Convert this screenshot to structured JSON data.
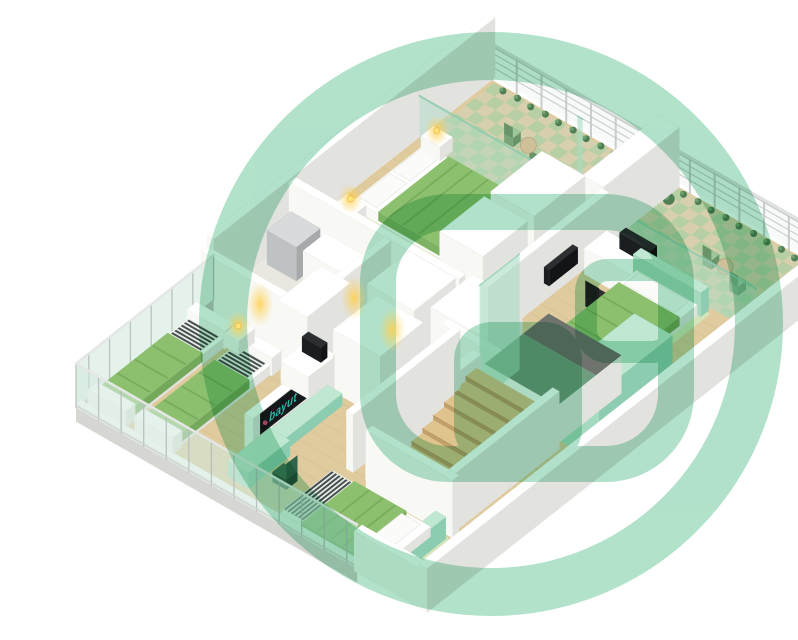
{
  "meta": {
    "alt": "3D isometric floor plan with bedrooms, balconies, bathroom and staircase"
  },
  "branding": {
    "tv_label": "bayut",
    "tv_label_color": "#2bb9ab",
    "tv_accent_color": "#e84b70",
    "watermark_color": "#abdfc6",
    "watermark_opacity": 0.92
  },
  "palette": {
    "floorWood": "#e0cb9e",
    "woodLine": "#d2bb8c",
    "floorBath": "#eae7e1",
    "tileBase": "#d8cfae",
    "tileGreen": "#9ccf9d",
    "matGreen": "#d4e7bc",
    "bedGreen": "#8cc06e",
    "bedGreenDark": "#74a85a",
    "bedDrape": "#7cb262",
    "stripeDark": "#3a4344",
    "stripeBase": "#eef0ea",
    "pillow": "#fbfbf9",
    "glassMint": "#a9dcc3",
    "glassPale": "#e3efe9",
    "slabGray": "#d6d6d2",
    "slabSide": "#c6c6c2",
    "railGlass": "#eff5f2",
    "railBar": "#c8cdcc",
    "railPost": "#c2c7c6",
    "railTop": "#dfe2e0",
    "mullion": "#b6bcba",
    "glassTopRail": "#e4e7e5",
    "stairWood": "#e0c48e",
    "stairRiser": "#c2a06a",
    "stairNose": "#b3925c",
    "landingGreen": "#6e9d7f",
    "voidGray": "#6e736e",
    "screenBlack": "#15181a",
    "tableTan": "#cfc09a",
    "plantDark": "#4f7f55",
    "plantLight": "#6fa06f",
    "mats": {
      "white": {
        "top": "#ffffff",
        "front": "#f8f8f5",
        "side": "#e2e2de"
      },
      "mint": {
        "top": "#c0e7d2",
        "front": "#a5dac1",
        "side": "#8cccb0"
      },
      "gray": {
        "top": "#d8dadb",
        "front": "#bfc2c3",
        "side": "#a6a9aa"
      },
      "dark": {
        "top": "#2b2f31",
        "front": "#1b1e20",
        "side": "#121415"
      },
      "chairBlack": {
        "top": "#2c3031",
        "front": "#1e2122",
        "side": "#151718"
      },
      "chairGreen": {
        "top": "#3c7b5a",
        "front": "#2f654a",
        "side": "#25543c"
      },
      "chairLeaf": {
        "top": "#9cc79d",
        "front": "#7aa57b",
        "side": "#699469"
      }
    }
  },
  "projection": {
    "origin": [
      452,
      64
    ],
    "u": [
      0.868,
      0.497
    ],
    "v": [
      -0.8,
      0.63
    ]
  },
  "watermark": {
    "ring": {
      "cx": 451,
      "cy": 308,
      "r": 268,
      "sw": 48
    },
    "outline": {
      "x": 338,
      "y": 196,
      "w": 298,
      "h": 252,
      "rx": 70,
      "sw": 36
    },
    "window": {
      "x": 546,
      "y": 254,
      "w": 88,
      "h": 82,
      "rx": 22,
      "sw": 22
    },
    "door": {
      "x": 414,
      "y": 306,
      "w": 128,
      "h": 144,
      "rx": 38
    }
  },
  "lights": {
    "lamps": [
      [
        23,
        94,
        20
      ],
      [
        23,
        202,
        20
      ],
      [
        56,
        378,
        20
      ]
    ],
    "glows": [
      [
        220,
        288
      ],
      [
        314,
        282
      ],
      [
        352,
        314
      ]
    ]
  },
  "scene": {
    "items": [
      {
        "t": "flat",
        "n": "floor-slab",
        "r": [
          0,
          0,
          398,
          520
        ],
        "f": "floorWood"
      },
      {
        "t": "woodlines",
        "n": "floor-planks",
        "r": [
          0,
          96,
          398,
          520
        ],
        "step": 14,
        "f": "woodLine"
      },
      {
        "t": "flat",
        "n": "bathroom-floor",
        "r": [
          0,
          250,
          116,
          360
        ],
        "f": "floorBath"
      },
      {
        "t": "flat",
        "n": "balcony-floor",
        "r": [
          4,
          2,
          192,
          94
        ],
        "f": "tileBase"
      },
      {
        "t": "checker",
        "n": "balcony-tiles",
        "r": [
          4,
          2,
          192,
          94
        ],
        "s": 12,
        "f": "tileGreen"
      },
      {
        "t": "flat",
        "n": "balcony-floor",
        "r": [
          216,
          2,
          396,
          94
        ],
        "f": "tileBase"
      },
      {
        "t": "checker",
        "n": "balcony-tiles",
        "r": [
          216,
          2,
          396,
          94
        ],
        "s": 12,
        "f": "tileGreen"
      },
      {
        "t": "flat",
        "n": "bed-mat",
        "r": [
          12,
          98,
          146,
          200
        ],
        "f": "matGreen",
        "op": 0.9
      },
      {
        "t": "flat",
        "n": "bed-mat",
        "r": [
          260,
          100,
          344,
          246
        ],
        "f": "matGreen",
        "op": 0.9
      },
      {
        "t": "flat",
        "n": "bed-mat",
        "r": [
          226,
          444,
          364,
          520
        ],
        "f": "matGreen",
        "op": 0.9
      },
      {
        "t": "railing",
        "n": "balcony-railing",
        "u": [
          0,
          398
        ],
        "v": 0,
        "h": 36
      },
      {
        "t": "wall",
        "n": "nw-wall",
        "r": [
          -8,
          -4,
          0,
          348
        ],
        "h": 60
      },
      {
        "t": "plants",
        "n": "balcony-plants",
        "pts": [
          [
            20,
            8
          ],
          [
            36,
            7
          ],
          [
            52,
            8
          ],
          [
            68,
            7
          ],
          [
            84,
            8
          ],
          [
            100,
            7
          ],
          [
            116,
            8
          ],
          [
            132,
            7
          ],
          [
            148,
            8
          ],
          [
            164,
            7
          ],
          [
            180,
            8
          ]
        ],
        "pr": 3.5
      },
      {
        "t": "plants",
        "n": "balcony-plants",
        "pts": [
          [
            228,
            8
          ],
          [
            244,
            7
          ],
          [
            260,
            8
          ],
          [
            276,
            7
          ],
          [
            292,
            8
          ],
          [
            308,
            7
          ],
          [
            324,
            8
          ],
          [
            340,
            7
          ],
          [
            356,
            8
          ],
          [
            372,
            7
          ],
          [
            388,
            8
          ]
        ],
        "pr": 3.5
      },
      {
        "t": "plants",
        "n": "balcony-plant-pots",
        "pts": [
          [
            222,
            20
          ],
          [
            388,
            26
          ]
        ],
        "pr": 6
      },
      {
        "t": "chair",
        "n": "balcony-chair",
        "at": [
          66,
          46
        ]
      },
      {
        "t": "chair",
        "n": "balcony-chair",
        "at": [
          106,
          58
        ]
      },
      {
        "t": "disk",
        "n": "balcony-table",
        "at": [
          88,
          50
        ],
        "dr": 8,
        "f": "tableTan",
        "z": 10
      },
      {
        "t": "chair",
        "n": "balcony-chair",
        "at": [
          302,
          54
        ]
      },
      {
        "t": "chair",
        "n": "balcony-chair",
        "at": [
          342,
          64
        ]
      },
      {
        "t": "disk",
        "n": "balcony-table",
        "at": [
          322,
          58
        ],
        "dr": 8,
        "f": "tableTan",
        "z": 10
      },
      {
        "t": "glassU",
        "n": "balcony-glass-partition",
        "u": [
          4,
          188
        ],
        "v": 95,
        "h": 46
      },
      {
        "t": "glassU",
        "n": "balcony-glass-partition",
        "u": [
          218,
          392
        ],
        "v": 95,
        "h": 46
      },
      {
        "t": "wall",
        "n": "balcony-divider-wall",
        "r": [
          192,
          0,
          216,
          95
        ],
        "h": 60
      },
      {
        "t": "vpanelU",
        "n": "glass-fin",
        "u": [
          186,
          192
        ],
        "v": 95,
        "h": 116
      },
      {
        "t": "bed",
        "n": "double-bed",
        "frame": [
          18,
          104,
          138,
          192
        ],
        "pillows": [
          [
            22,
            110,
            42,
            148
          ],
          [
            22,
            152,
            42,
            190
          ]
        ],
        "blanket": [
          46,
          104,
          138,
          192
        ],
        "sAxis": "u",
        "sRange": [
          118,
          138
        ],
        "fAxis": "u",
        "folds": [
          58,
          74,
          92
        ]
      },
      {
        "t": "box",
        "n": "nightstand",
        "r": [
          12,
          86,
          34,
          102
        ],
        "h": 14,
        "m": "white"
      },
      {
        "t": "box",
        "n": "nightstand",
        "r": [
          12,
          194,
          34,
          210
        ],
        "h": 14,
        "m": "white"
      },
      {
        "t": "box",
        "n": "wardrobe",
        "r": [
          146,
          96,
          196,
          160
        ],
        "h": 62,
        "m": "white"
      },
      {
        "t": "box",
        "n": "wardrobe",
        "r": [
          146,
          168,
          196,
          224
        ],
        "h": 62,
        "m": "white"
      },
      {
        "t": "wall",
        "n": "bathroom-wall",
        "r": [
          0,
          246,
          196,
          254
        ],
        "h": 58
      },
      {
        "t": "box",
        "n": "washer",
        "r": [
          6,
          258,
          40,
          288
        ],
        "h": 34,
        "m": "gray"
      },
      {
        "t": "box",
        "n": "bathroom-counter",
        "r": [
          44,
          256,
          108,
          284
        ],
        "h": 30,
        "m": "white"
      },
      {
        "t": "wall",
        "n": "bathroom-wall",
        "r": [
          110,
          254,
          118,
          332
        ],
        "h": 58
      },
      {
        "t": "wall",
        "n": "bathroom-wall",
        "r": [
          0,
          356,
          152,
          364
        ],
        "h": 58
      },
      {
        "t": "box",
        "n": "wardrobe",
        "r": [
          142,
          258,
          196,
          310
        ],
        "h": 62,
        "m": "white"
      },
      {
        "t": "box",
        "n": "wardrobe",
        "r": [
          204,
          246,
          262,
          298
        ],
        "h": 62,
        "m": "white"
      },
      {
        "t": "box",
        "n": "wardrobe",
        "r": [
          96,
          318,
          130,
          372
        ],
        "h": 62,
        "m": "white"
      },
      {
        "t": "box",
        "n": "wardrobe",
        "r": [
          158,
          316,
          212,
          370
        ],
        "h": 62,
        "m": "white"
      },
      {
        "t": "wall",
        "n": "bedroom-wall",
        "r": [
          214,
          95,
          222,
          246
        ],
        "h": 58
      },
      {
        "t": "box",
        "n": "desk",
        "r": [
          226,
          102,
          310,
          130
        ],
        "h": 26,
        "m": "white"
      },
      {
        "t": "box",
        "n": "desk-monitor",
        "r": [
          250,
          104,
          286,
          112
        ],
        "h": 16,
        "z0": 26,
        "m": "dark"
      },
      {
        "t": "box",
        "n": "wall-screen",
        "r": [
          222,
          140,
          228,
          176
        ],
        "h": 16,
        "z0": 18,
        "m": "dark"
      },
      {
        "t": "ochair",
        "n": "office-chair",
        "at": [
          262,
          152
        ],
        "m": "chairBlack",
        "back": "v"
      },
      {
        "t": "box",
        "n": "bed-headboard",
        "r": [
          262,
          98,
          340,
          108
        ],
        "h": 24,
        "m": "mint"
      },
      {
        "t": "bed",
        "n": "single-bed",
        "frame": [
          266,
          108,
          336,
          238
        ],
        "pillows": [
          [
            272,
            112,
            330,
            130
          ]
        ],
        "blanket": [
          266,
          130,
          336,
          214
        ],
        "sAxis": "v",
        "sRange": [
          214,
          238
        ],
        "fAxis": "v",
        "folds": [
          152,
          172,
          192
        ]
      },
      {
        "t": "wall",
        "n": "bedroom-wall",
        "r": [
          222,
          296,
          348,
          304
        ],
        "h": 58
      },
      {
        "t": "wall",
        "n": "bedroom-wall",
        "r": [
          368,
          296,
          398,
          304
        ],
        "h": 58
      },
      {
        "t": "box",
        "n": "lift-shaft",
        "r": [
          352,
          204,
          396,
          296
        ],
        "h": 70,
        "m": "mint"
      },
      {
        "t": "wall",
        "n": "landing-base",
        "r": [
          268,
          220,
          352,
          300
        ],
        "h": 38
      },
      {
        "t": "flat",
        "n": "stair-void",
        "r": [
          268,
          220,
          352,
          252
        ],
        "z": 38.3,
        "f": "voidGray"
      },
      {
        "t": "flat",
        "n": "stair-landing",
        "r": [
          268,
          252,
          352,
          300
        ],
        "z": 38.3,
        "f": "landingGreen"
      },
      {
        "t": "vpanelV",
        "n": "glass-fin",
        "u": 264,
        "v": [
          252,
          302
        ],
        "h": 116
      },
      {
        "t": "wall",
        "n": "stair-wall",
        "r": [
          254,
          300,
          264,
          434
        ],
        "h": 46
      },
      {
        "t": "wall",
        "n": "stair-wall",
        "r": [
          340,
          300,
          350,
          434
        ],
        "h": 46
      },
      {
        "t": "stairs",
        "n": "staircase",
        "u": [
          264,
          340
        ],
        "v0": 306,
        "count": 9,
        "d": 13.5,
        "ztop": 36,
        "drop": 4.5
      },
      {
        "t": "wall",
        "n": "hall-wall",
        "r": [
          232,
          300,
          240,
          434
        ],
        "h": 58
      },
      {
        "t": "wall",
        "n": "bedroom-wall",
        "r": [
          350,
          304,
          358,
          438
        ],
        "h": 58
      },
      {
        "t": "wall",
        "n": "bedroom-wall",
        "r": [
          262,
          434,
          362,
          442
        ],
        "h": 58
      },
      {
        "t": "wall",
        "n": "media-wall",
        "r": [
          148,
          368,
          158,
          470
        ],
        "h": 36
      },
      {
        "t": "box",
        "n": "media-console",
        "r": [
          158,
          378,
          176,
          466
        ],
        "h": 12,
        "m": "mint"
      },
      {
        "t": "tv",
        "n": "tv-screen",
        "u": 158.6,
        "v": [
          388,
          462
        ],
        "z": [
          15,
          36
        ]
      },
      {
        "t": "box",
        "n": "desk",
        "r": [
          116,
          358,
          148,
          390
        ],
        "h": 22,
        "m": "white"
      },
      {
        "t": "box",
        "n": "desk-monitor",
        "r": [
          122,
          362,
          144,
          370
        ],
        "h": 15,
        "z0": 22,
        "m": "dark"
      },
      {
        "t": "frontglassV",
        "n": "window-wall",
        "u": 0,
        "v": [
          348,
          520
        ],
        "h": 44
      },
      {
        "t": "box",
        "n": "bed-headboard",
        "r": [
          6,
          376,
          50,
          388
        ],
        "h": 18,
        "m": "white"
      },
      {
        "t": "bed",
        "n": "twin-bed",
        "frame": [
          8,
          388,
          48,
          502
        ],
        "pillows": [],
        "blanket": [
          8,
          414,
          48,
          500
        ],
        "sAxis": "v",
        "sRange": [
          390,
          414
        ],
        "fAxis": "v",
        "folds": [
          434,
          456,
          478
        ]
      },
      {
        "t": "box",
        "n": "bed-footboard",
        "r": [
          6,
          500,
          50,
          512
        ],
        "h": 16,
        "m": "white"
      },
      {
        "t": "box",
        "n": "bed-headboard",
        "r": [
          60,
          376,
          104,
          388
        ],
        "h": 18,
        "m": "white"
      },
      {
        "t": "bed",
        "n": "twin-bed",
        "frame": [
          62,
          388,
          102,
          502
        ],
        "pillows": [],
        "blanket": [
          62,
          414,
          102,
          500
        ],
        "sAxis": "v",
        "sRange": [
          390,
          414
        ],
        "fAxis": "v",
        "folds": [
          434,
          456,
          478
        ]
      },
      {
        "t": "box",
        "n": "bed-footboard",
        "r": [
          60,
          500,
          104,
          512
        ],
        "h": 16,
        "m": "white"
      },
      {
        "t": "box",
        "n": "nightstand",
        "r": [
          48,
          366,
          64,
          386
        ],
        "h": 14,
        "m": "white"
      },
      {
        "t": "box",
        "n": "desk",
        "r": [
          160,
          452,
          184,
          504
        ],
        "h": 16,
        "m": "mint"
      },
      {
        "t": "ochair",
        "n": "desk-chair",
        "at": [
          202,
          478
        ],
        "m": "chairGreen",
        "back": "u"
      },
      {
        "t": "box",
        "n": "bed-headboard",
        "r": [
          346,
          446,
          358,
          518
        ],
        "h": 22,
        "m": "mint"
      },
      {
        "t": "bed",
        "n": "single-bed",
        "frame": [
          234,
          452,
          346,
          518
        ],
        "pillows": [
          [
            318,
            458,
            340,
            512
          ]
        ],
        "blanket": [
          258,
          452,
          318,
          518
        ],
        "sAxis": "u",
        "sRange": [
          234,
          258
        ],
        "fAxis": "u",
        "folds": [
          276,
          292,
          306
        ]
      },
      {
        "t": "box",
        "n": "window-sill",
        "r": [
          0,
          514,
          324,
          520
        ],
        "h": 4,
        "m": "white"
      },
      {
        "t": "frontglassU",
        "n": "window-wall",
        "v": 520,
        "u": [
          0,
          324
        ],
        "h": 44
      },
      {
        "t": "wall",
        "n": "sw-wall",
        "r": [
          324,
          514,
          400,
          524
        ],
        "h": 40
      },
      {
        "t": "wall",
        "n": "se-wall",
        "r": [
          398,
          -4,
          408,
          524
        ],
        "h": 44
      }
    ]
  }
}
